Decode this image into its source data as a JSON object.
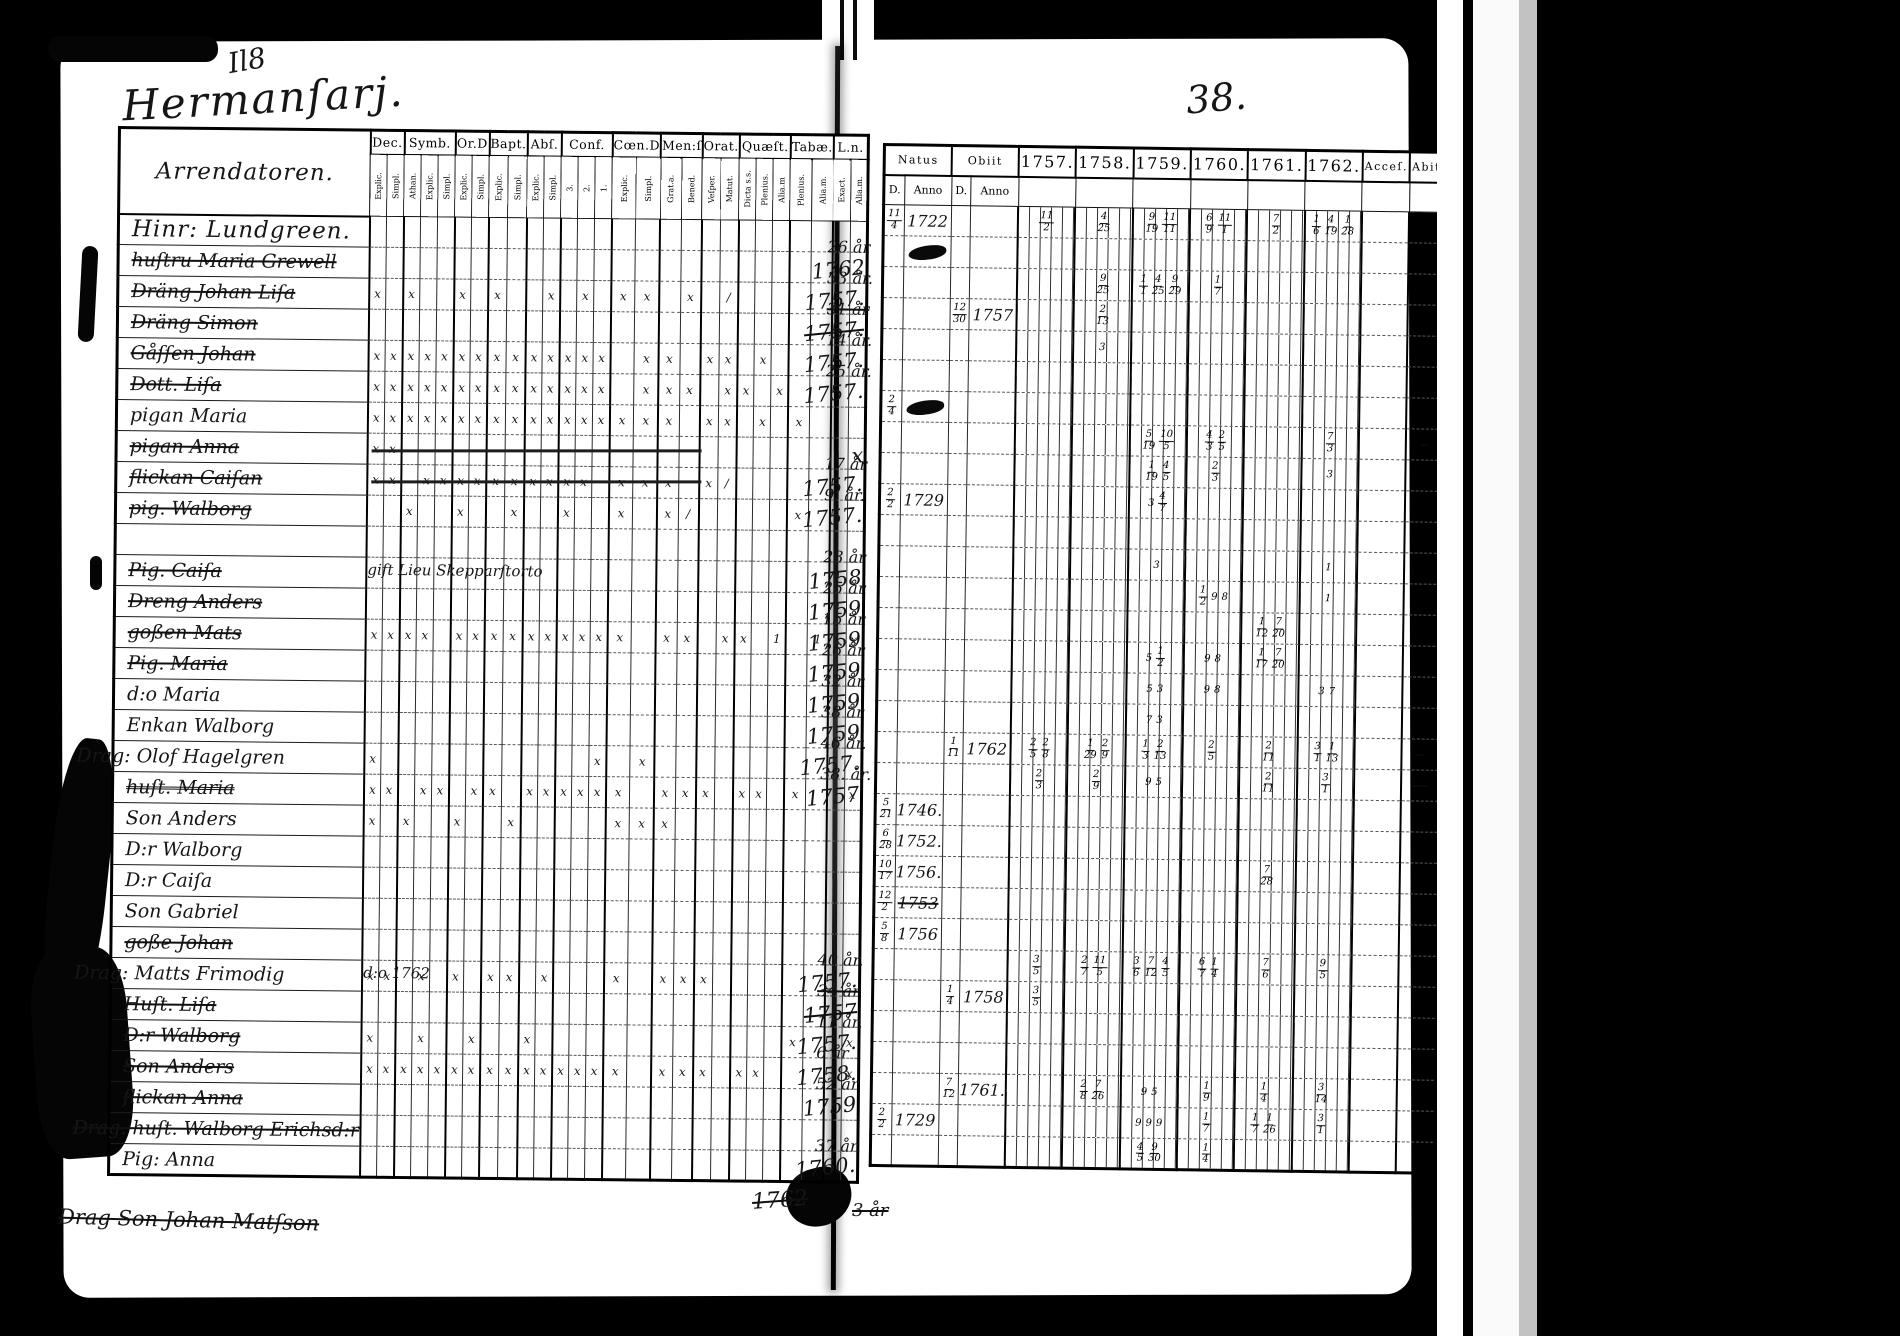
{
  "scan": {
    "flourish": "Il8",
    "title": "Hermanſarj.",
    "page_number": "38.",
    "left_table": {
      "name_header": "Arrendatoren.",
      "groups": [
        {
          "label": "Dec.",
          "subs": [
            "Explic.",
            "Simpl."
          ]
        },
        {
          "label": "Symb.",
          "subs": [
            "Athan.",
            "Explic.",
            "Simpl."
          ]
        },
        {
          "label": "Or.D",
          "subs": [
            "Explic.",
            "Simpl."
          ]
        },
        {
          "label": "Bapt.",
          "subs": [
            "Explic.",
            "Simpl."
          ]
        },
        {
          "label": "Abſ.",
          "subs": [
            "Explic.",
            "Simpl."
          ]
        },
        {
          "label": "Conf.",
          "subs": [
            "3.",
            "2.",
            "1."
          ]
        },
        {
          "label": "Cœn.D",
          "subs": [
            "Explic.",
            "Simpl."
          ]
        },
        {
          "label": "Men:ſ",
          "subs": [
            "Grat.a.",
            "Bened."
          ]
        },
        {
          "label": "Orat.",
          "subs": [
            "Veſper.",
            "Matut."
          ]
        },
        {
          "label": "Quæſt.",
          "subs": [
            "Dicta s.s.",
            "Plenius.",
            "Alia.m"
          ]
        },
        {
          "label": "Tabæ.",
          "subs": [
            "Plenius.",
            "Alia.m."
          ]
        },
        {
          "label": "L.n.",
          "subs": [
            "Exact.",
            "Alia.m."
          ]
        }
      ]
    },
    "right_table": {
      "natus": "Natus",
      "obiit": "Obiit",
      "d": "D.",
      "anno": "Anno",
      "years": [
        "1757.",
        "1758.",
        "1759.",
        "1760.",
        "1761.",
        "1762."
      ],
      "acce": "Acceſ.",
      "abit": "Abit."
    },
    "rows": [
      {
        "n": "Hinr: Lundgreen.",
        "big": 1,
        "nat": "11/4 1722",
        "y": [
          "11/2",
          "4/25",
          "9/19 11/11",
          "6/9 11/1",
          "7/2",
          "1/6 4/19 1/28"
        ]
      },
      {
        "n": "huſtru Maria Grewell",
        "s": 1,
        "ln": "1762",
        "age": "26 år",
        "natb": 1
      },
      {
        "n": "Dräng Johan Liſa",
        "s": 1,
        "m": "x.x..x.x..x.x.xx.x./.......",
        "ln": "1757.",
        "age": "33 år.",
        "y": [
          "",
          "9/25",
          "1/1 4/25 9/29",
          "1/7",
          "",
          ""
        ]
      },
      {
        "n": "Dräng Simon",
        "s": 1,
        "ln": "1757.",
        "lns": 1,
        "age": "31 år",
        "ages": 1,
        "ob": "12/30 1757",
        "y": [
          "",
          "2/13",
          "",
          "",
          "",
          ""
        ]
      },
      {
        "n": "Gåſſen Johan",
        "s": 1,
        "m": "xxxxxxxxxxxxxx.xx.xx.x.....",
        "ln": "1757.",
        "age": "14 år.",
        "y": [
          "",
          "3",
          "",
          "",
          "",
          ""
        ]
      },
      {
        "n": "Dott. Liſa",
        "s": 1,
        "m": "xxxxxxxxxxxxxx.xxx.xx.x....",
        "ln": "1757.",
        "age": "25 år."
      },
      {
        "n": "pigan Maria",
        "m": "xxxxxxxxxxxxxxxxx.xx.x.x...",
        "nat": "2/4",
        "natb": 1
      },
      {
        "n": "pigan Anna",
        "s": 1,
        "scr": 1,
        "m": "xx.........................",
        "ln": "x",
        "y": [
          "",
          "",
          "5/19 10/5",
          "4/3 2/5",
          "",
          "7/3"
        ],
        "ab": "3/9"
      },
      {
        "n": "flickan Caiſan",
        "s": 1,
        "scr": 1,
        "m": "xx.xxxxxxxxxx.xxx.x/.......",
        "ln": "1757.",
        "age": "17 år",
        "y": [
          "",
          "",
          "1/19 4/5",
          "2/3",
          "",
          "3"
        ]
      },
      {
        "n": "pig. Walborg",
        "s": 1,
        "m": "..x..x..x..x..x.x/.....x...",
        "ln": "1757.",
        "age": "9. år.",
        "nat": "2/2 1729",
        "y": [
          "",
          "",
          "3 4/7",
          "",
          "",
          ""
        ]
      },
      {},
      {
        "n": "Pig. Caiſa",
        "s": 1,
        "note": "gift Lieu Skepparſtorto",
        "ln": "1758",
        "age": "23 år",
        "y": [
          "",
          "",
          "3",
          "",
          "",
          "1"
        ]
      },
      {
        "n": "Dreng Anders",
        "s": 1,
        "ln": "1759",
        "age": "25 år",
        "y": [
          "",
          "",
          "",
          "1/2 9 8",
          "",
          "1"
        ]
      },
      {
        "n": "goßen Mats",
        "s": 1,
        "m": "xxxx.xxxxxxxxxx.xx.xx.1.1xx",
        "ln": "1759",
        "age": "15 år",
        "y": [
          "",
          "",
          "",
          "",
          "1/12 7/20",
          ""
        ]
      },
      {
        "n": "Pig. Maria",
        "s": 1,
        "ln": "1759",
        "age": "26 år",
        "y": [
          "",
          "",
          "5 1/2",
          "9 8",
          "1/17 7/20",
          ""
        ]
      },
      {
        "n": "d:o Maria",
        "ln": "1759",
        "age": "32 år",
        "y": [
          "",
          "",
          "5 3",
          "9 8",
          "",
          "3 7"
        ]
      },
      {
        "n": "Enkan Walborg",
        "ln": "1759",
        "age": "38 år",
        "y": [
          "",
          "",
          "7 3",
          "",
          "",
          ""
        ]
      },
      {
        "n": "Drag: Olof Hagelgren",
        "mo": 1,
        "m": "x............x.x...........",
        "ln": "1757.",
        "age": "46 år.",
        "ob": "1/11 1762",
        "y": [
          "2/5 2/8",
          "1/29 2/9",
          "1/3 2/13",
          "2/5",
          "2/11",
          "3/1 1/13"
        ],
        "ab": "1/13"
      },
      {
        "n": "huſt. Maria",
        "s": 2,
        "m": "xx.xx.xx.xxxxxx.xxx.xx.x..x",
        "ln": "1757",
        "age": "38. år.",
        "y": [
          "2/3",
          "2/9",
          "9 5",
          "",
          "2/11",
          "3/1"
        ],
        "ab": "12/3"
      },
      {
        "n": "Son Anders",
        "m": "x.x..x..x.....xxx..........",
        "nat": "5/21 1746."
      },
      {
        "n": "D:r Walborg",
        "nat": "6/28 1752."
      },
      {
        "n": "D:r Caiſa",
        "nat": "10/17 1756.",
        "y": [
          "",
          "",
          "",
          "",
          "7/28",
          ""
        ]
      },
      {
        "n": "Son Gabriel",
        "nat": "12/2 1753",
        "nats": 1
      },
      {
        "n": "goße Johan",
        "s": 1,
        "nat": "5/8 1756"
      },
      {
        "n": "Drag: Matts Frimodig",
        "mo": 1,
        "note": "d:o 1762",
        "m": "xx.x.x.xx.x...x.xxx........",
        "ln": "1757.",
        "age": "40 år.",
        "y": [
          "3/5",
          "2/7 11/5",
          "3/6 7/12 4/5",
          "6/7 1/4",
          "7/6",
          "9/5"
        ]
      },
      {
        "n": "Huſt. Liſa",
        "s": 1,
        "ln": "1757",
        "lns": 1,
        "age": "34 år",
        "ages": 1,
        "ob": "1/4 1758",
        "y": [
          "3/5",
          "",
          "",
          "",
          "",
          ""
        ]
      },
      {
        "n": "D:r Walborg",
        "s": 1,
        "m": "x..x..x..x.............x..x",
        "ln": "1757.",
        "age": "11 år."
      },
      {
        "n": "Son Anders",
        "s": 1,
        "m": "xxxxxxxxxxxxxxx.xxx.xx....x",
        "ln": "1758.",
        "age": "6 år"
      },
      {
        "n": "flickan Anna",
        "s": 1,
        "ln": "1759",
        "age": "52 år",
        "ob": "7/12 1761.",
        "y": [
          "",
          "2/8 7/26",
          "9 5",
          "1/9",
          "1/4",
          "3/14"
        ]
      },
      {
        "n": "Drag. huſt. Walborg Erichsd:r",
        "s": 1,
        "mo": 1,
        "nat": "2/2 1729",
        "y": [
          "",
          "",
          "9 9 9",
          "1/7",
          "1/7 1/26",
          "3/1"
        ]
      },
      {
        "n": "Pig: Anna",
        "ln": "1760.",
        "age": "37 år.",
        "y": [
          "",
          "",
          "4/5 9/30",
          "1/4",
          "",
          ""
        ]
      }
    ],
    "footer": {
      "name": "Drag Son Johan Matſson",
      "year": "1762",
      "age": "3 år"
    }
  }
}
